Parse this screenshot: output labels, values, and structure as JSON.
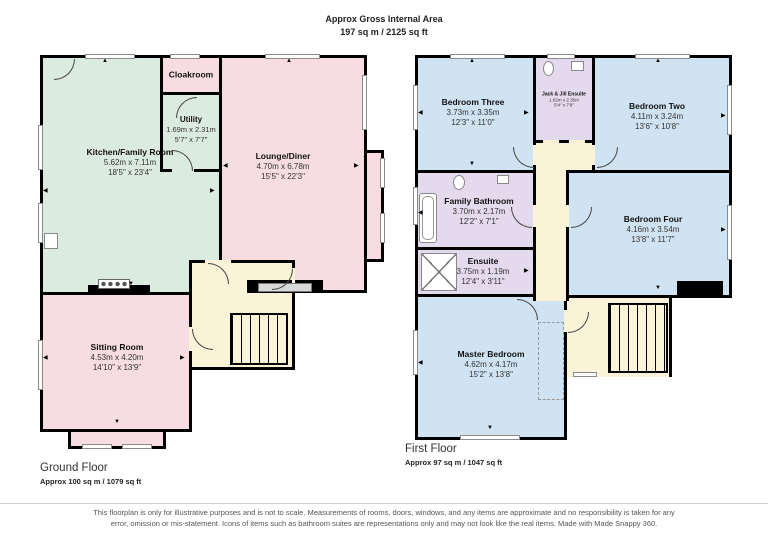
{
  "header": {
    "title": "Approx Gross Internal Area",
    "area": "197 sq m / 2125 sq ft"
  },
  "ground": {
    "label": "Ground Floor",
    "area": "Approx 100 sq m / 1079 sq ft",
    "rooms": {
      "kitchen": {
        "name": "Kitchen/Family Room",
        "metric": "5.62m x 7.11m",
        "imperial": "18'5\" x 23'4\""
      },
      "cloakroom": {
        "name": "Cloakroom"
      },
      "utility": {
        "name": "Utility",
        "metric": "1.69m x 2.31m",
        "imperial": "5'7\" x 7'7\""
      },
      "lounge": {
        "name": "Lounge/Diner",
        "metric": "4.70m x 6.78m",
        "imperial": "15'5\" x 22'3\""
      },
      "sitting": {
        "name": "Sitting Room",
        "metric": "4.53m x 4.20m",
        "imperial": "14'10\" x 13'9\""
      }
    }
  },
  "first": {
    "label": "First Floor",
    "area": "Approx 97 sq m / 1047 sq ft",
    "rooms": {
      "bed3": {
        "name": "Bedroom Three",
        "metric": "3.73m x 3.35m",
        "imperial": "12'3\" x 11'0\""
      },
      "jackjill": {
        "name": "Jack & Jill Ensuite",
        "metric": "1.62m x 2.35m",
        "imperial": "5'4\" x 7'9\""
      },
      "bed2": {
        "name": "Bedroom Two",
        "metric": "4.11m x 3.24m",
        "imperial": "13'6\" x 10'8\""
      },
      "familybath": {
        "name": "Family Bathroom",
        "metric": "3.70m x 2.17m",
        "imperial": "12'2\" x 7'1\""
      },
      "bed4": {
        "name": "Bedroom Four",
        "metric": "4.16m x 3.54m",
        "imperial": "13'8\" x 11'7\""
      },
      "ensuite": {
        "name": "Ensuite",
        "metric": "3.75m x 1.19m",
        "imperial": "12'4\" x 3'11\""
      },
      "master": {
        "name": "Master Bedroom",
        "metric": "4.62m x 4.17m",
        "imperial": "15'2\" x 13'8\""
      }
    }
  },
  "footer": {
    "disclaimer": "This floorplan is only for illustrative purposes and is not to scale. Measurements of rooms, doors, windows, and any items are approximate and no responsibility is taken for any error, omission or mis-statement. Icons of items such as bathroom suites are representations only and may not look like the real items. Made with Made Snappy 360."
  },
  "colors": {
    "living": "#f7dce1",
    "kitchen": "#dcebdf",
    "hall": "#faf3d8",
    "bedroom": "#cfe3f2",
    "bathroom": "#e4daee",
    "wall": "#000000"
  }
}
